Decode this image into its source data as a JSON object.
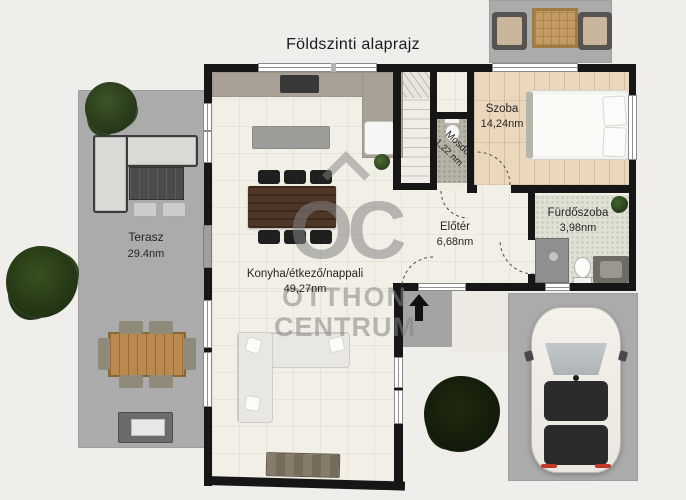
{
  "title": "Földszinti alaprajz",
  "watermark": {
    "logo_text": "OC",
    "brand_line1": "OTTHON",
    "brand_line2": "CENTRUM"
  },
  "rooms": {
    "terasz": {
      "name": "Terasz",
      "area": "29.4nm"
    },
    "nappali": {
      "name": "Konyha/étkező/nappali",
      "area": "49,27nm"
    },
    "eloter": {
      "name": "Előtér",
      "area": "6,68nm"
    },
    "mosdo": {
      "name": "Mosdó",
      "area": "1,22 nm"
    },
    "szoba": {
      "name": "Szoba",
      "area": "14,24nm"
    },
    "furdoszoba": {
      "name": "Fürdőszoba",
      "area": "3,98nm"
    }
  },
  "colors": {
    "background": "#efeeea",
    "paving_gray": "#ababab",
    "wall_black": "#161616",
    "wood_floor": "#ead7bc",
    "tile_floor": "#f2efe6",
    "watermark_gray": "#8a8a8a"
  }
}
